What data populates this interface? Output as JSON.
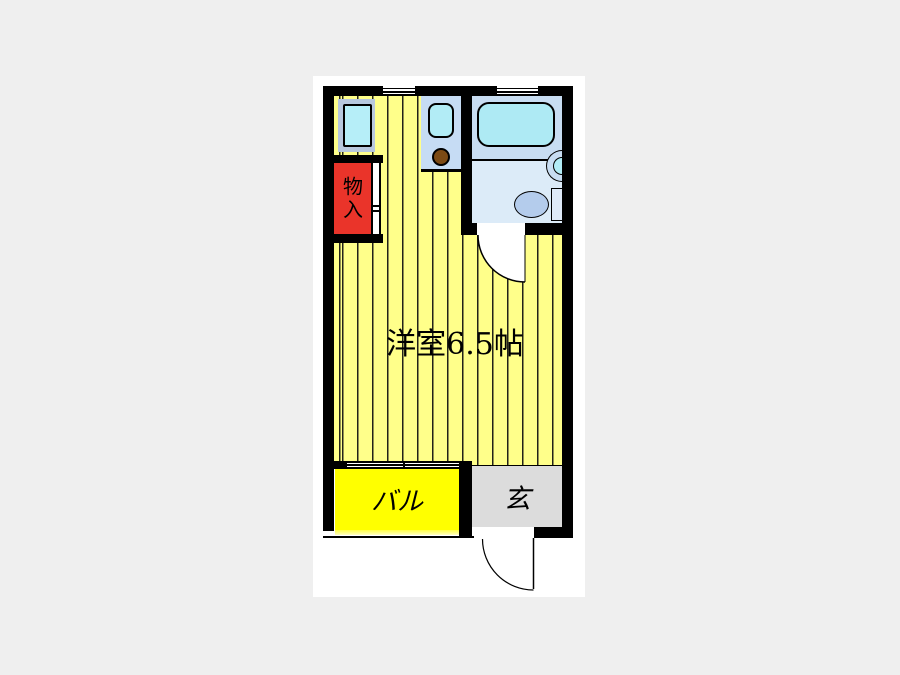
{
  "floorplan": {
    "rooms": {
      "main_room": {
        "label": "洋室6.5帖"
      },
      "balcony": {
        "label": "バル"
      },
      "entrance": {
        "label": "玄"
      },
      "closet": {
        "label": "物入"
      }
    },
    "fixtures": {
      "bathtub": "bathtub",
      "toilet": "toilet",
      "wash_basin": "wash-basin",
      "kitchen_sink": "kitchen-sink",
      "stove_burner": "stove-burner",
      "washing_machine_space": "washing-machine-space"
    },
    "colors": {
      "background": "#efefef",
      "page": "#ffffff",
      "wall": "#000000",
      "room_floor": "#ffff8a",
      "balcony": "#ffff00",
      "balcony_edge": "#ffffc0",
      "entrance_floor": "#dcdcdc",
      "closet_fill": "#ea342a",
      "fixture_panel": "#c6dcf4",
      "bath_upper": "#c8ddf2",
      "bath_lower": "#dcebf8",
      "tub_fill": "#aeeaf4",
      "sink_fill": "#b2ecf6",
      "washer_outer": "#b8c8de",
      "washer_inner": "#b6eef8",
      "burner": "#7c4a14",
      "toilet_bowl": "#b4ccec",
      "toilet_tank": "#dfeaf8"
    }
  }
}
